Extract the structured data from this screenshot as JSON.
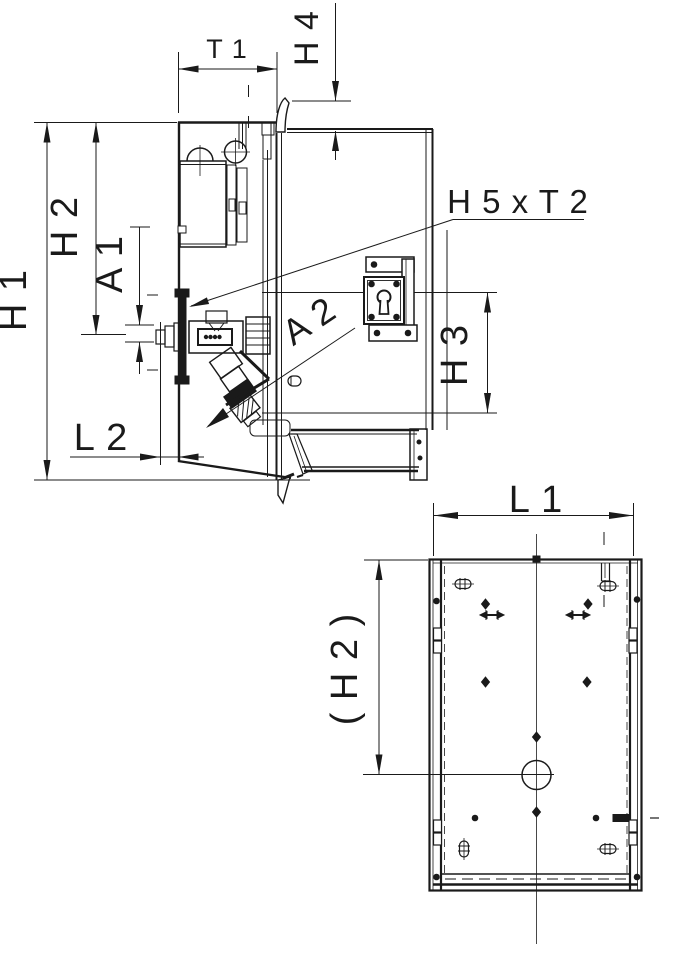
{
  "drawing": {
    "type": "technical-dimension-drawing",
    "line_color": "#1a1a1a",
    "background_color": "#ffffff"
  },
  "labels": {
    "h1": "H 1",
    "h2": "H 2",
    "a1": "A 1",
    "l2": "L 2",
    "t1": "T 1",
    "h4": "H 4",
    "h5xt2": "H 5 x T 2",
    "a2": "A 2",
    "h3": "H 3",
    "l1": "L 1",
    "h2_ref": "( H 2 )"
  }
}
